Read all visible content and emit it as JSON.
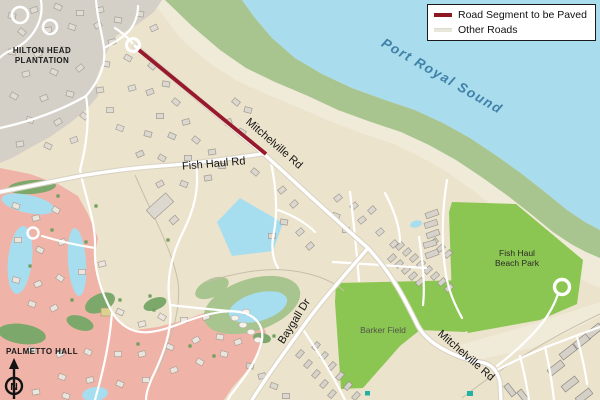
{
  "legend": {
    "items": [
      {
        "label": "Road Segment to be Paved",
        "color": "#8e1722"
      },
      {
        "label": "Other Roads",
        "color": "#e9e6dc"
      }
    ]
  },
  "labels": {
    "water": "Port Royal Sound",
    "plantation_line1": "HILTON HEAD",
    "plantation_line2": "PLANTATION",
    "palmetto": "PALMETTO HALL",
    "mitchelville_upper": "Mitchelville Rd",
    "mitchelville_lower": "Mitchelville Rd",
    "fish_haul_rd": "Fish Haul Rd",
    "baygall_dr": "Baygall Dr",
    "beach_park_line1": "Fish Haul",
    "beach_park_line2": "Beach Park",
    "barker_field": "Barker Field",
    "north": "N"
  },
  "colors": {
    "land_tan": "#ece3cc",
    "water_blue": "#a9dcec",
    "pond_blue": "#a6def0",
    "marsh_green": "#a8c48f",
    "beach_sand": "#f0ead9",
    "park_green": "#8bc653",
    "plantation_gray": "#d4d0c8",
    "palmetto_pink": "#efb3a7",
    "paved_segment_red": "#97192b",
    "road_white": "#ffffff"
  }
}
